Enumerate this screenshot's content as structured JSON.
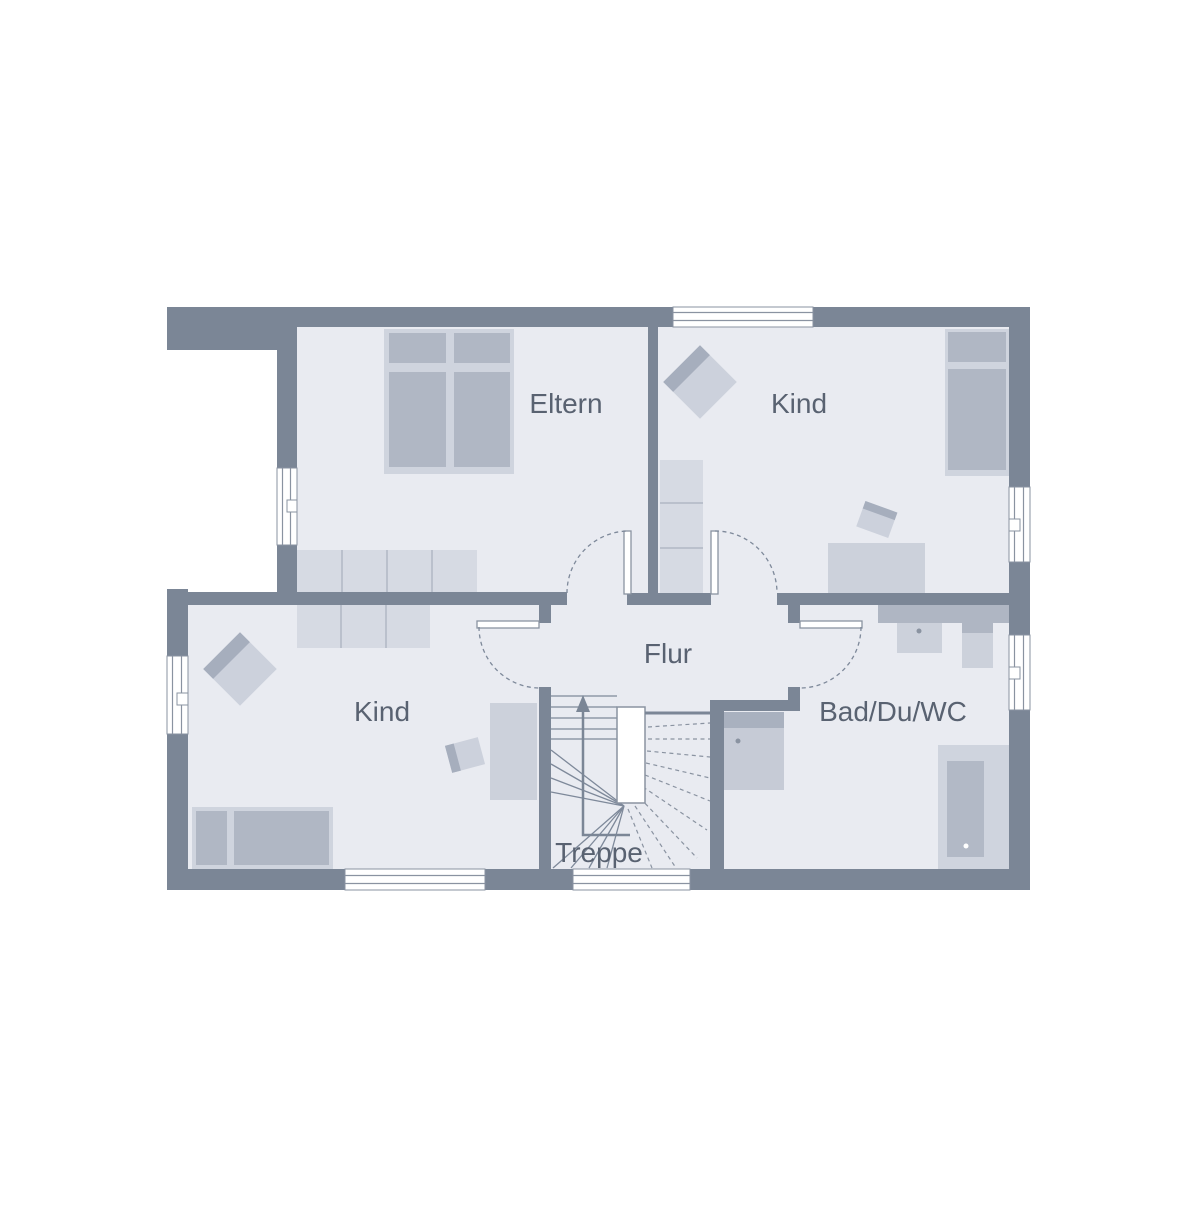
{
  "plan": {
    "type": "floor-plan",
    "floor": "upper-floor",
    "rooms": {
      "eltern": {
        "label": "Eltern"
      },
      "kind_top": {
        "label": "Kind"
      },
      "kind_bottom": {
        "label": "Kind"
      },
      "flur": {
        "label": "Flur"
      },
      "bad": {
        "label": "Bad/Du/WC"
      },
      "treppe": {
        "label": "Treppe"
      }
    },
    "colors": {
      "background": "#ffffff",
      "wall": "#7b8696",
      "floor": "#e9ebf1",
      "outline": "#8a93a1",
      "furniture_light": "#cfd4de",
      "furniture_pale": "#d6dae3",
      "furniture_medium": "#b0b7c4",
      "fixture_light": "#ccd1db",
      "fixture_dark": "#a9b1bf",
      "text": "#596271"
    },
    "fixtures": [
      "double-bed",
      "single-bed",
      "wardrobe",
      "armchair",
      "desk",
      "desk-chair",
      "winder-staircase",
      "up-arrow",
      "shower",
      "washbasin",
      "wc",
      "bathtub",
      "window",
      "door-swing"
    ]
  }
}
